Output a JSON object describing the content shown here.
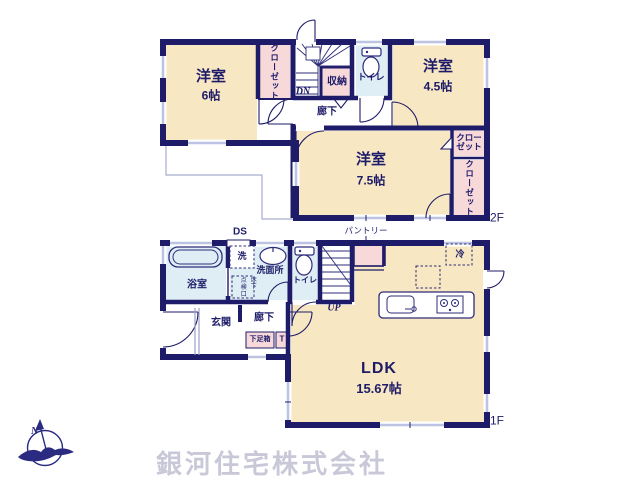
{
  "colors": {
    "wall": "#1e1c69",
    "room_fill": "#f8e7c3",
    "closet_fill": "#f8d9da",
    "wet_area_fill": "#dfeef5",
    "window_marker": "#bdc3e2",
    "company_text": "#c8c8d8",
    "logo": "#2b2b82"
  },
  "floor2": {
    "label": "2F",
    "room6_name": "洋室",
    "room6_size": "6帖",
    "room45_name": "洋室",
    "room45_size": "4.5帖",
    "room75_name": "洋室",
    "room75_size": "7.5帖",
    "closet_left": "クローゼット",
    "closet_right_upper_line1": "クロー",
    "closet_right_upper_line2": "ゼット",
    "closet_right_lower": "クローゼット",
    "storage": "収納",
    "toilet": "トイレ",
    "hallway": "廊下",
    "stairs_down": "DN"
  },
  "floor1": {
    "label": "1F",
    "ldk_name": "LDK",
    "ldk_size": "15.67帖",
    "bath": "浴室",
    "washer": "洗",
    "washroom": "洗面所",
    "hatch": "点検口",
    "underfloor": "床下",
    "toilet": "トイレ",
    "stairs_up": "UP",
    "entrance": "玄関",
    "hallway": "廊下",
    "shoebox": "下足箱",
    "t_mark": "T",
    "fridge": "冷"
  },
  "annotations": {
    "ds": "DS",
    "pantry": "パントリー"
  },
  "footer": {
    "company": "銀河住宅株式会社",
    "compass_n": "N"
  }
}
